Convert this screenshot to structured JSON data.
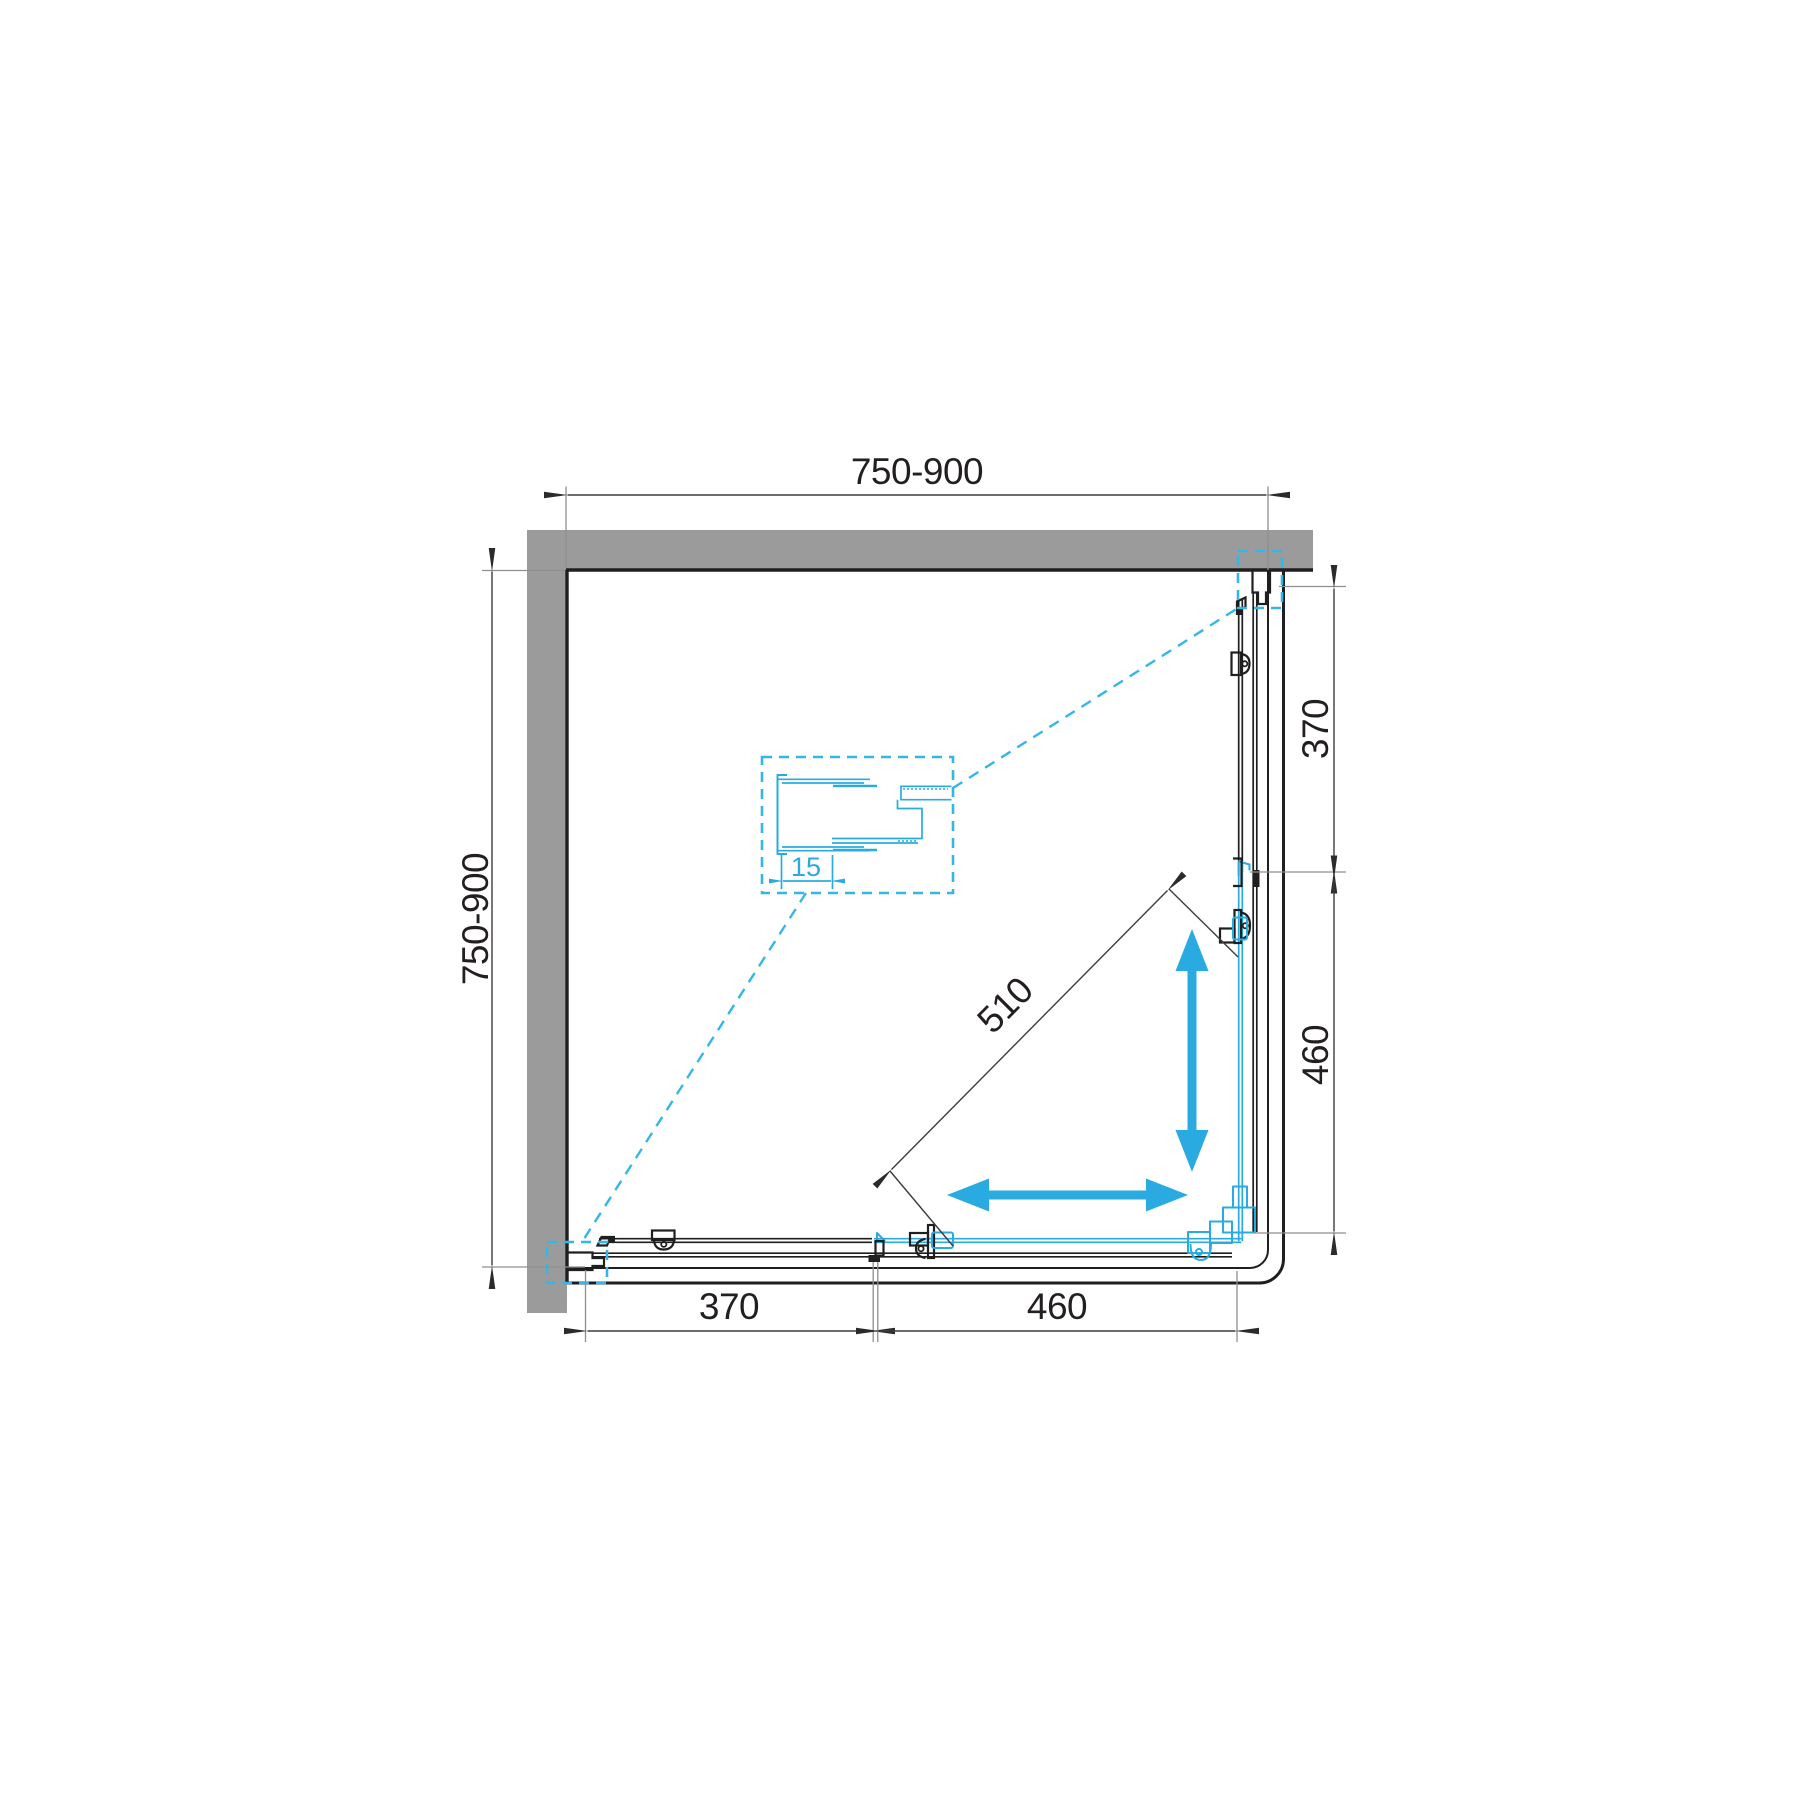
{
  "drawing": {
    "title": "Square corner shower enclosure - plan view technical drawing",
    "units": "mm",
    "colors": {
      "accent_cyan": "#29ABE2",
      "wall_gray": "#9B9B9B",
      "line_black": "#1F1F1F",
      "dim_line_gray": "#3D3D3D"
    },
    "dims": {
      "top_width": "750-900",
      "left_depth": "750-900",
      "right_fixed_panel": "370",
      "right_door_span": "460",
      "bottom_fixed_panel": "370",
      "bottom_door_span": "460",
      "diagonal_entry": "510",
      "profile_adjustment": "15"
    }
  }
}
